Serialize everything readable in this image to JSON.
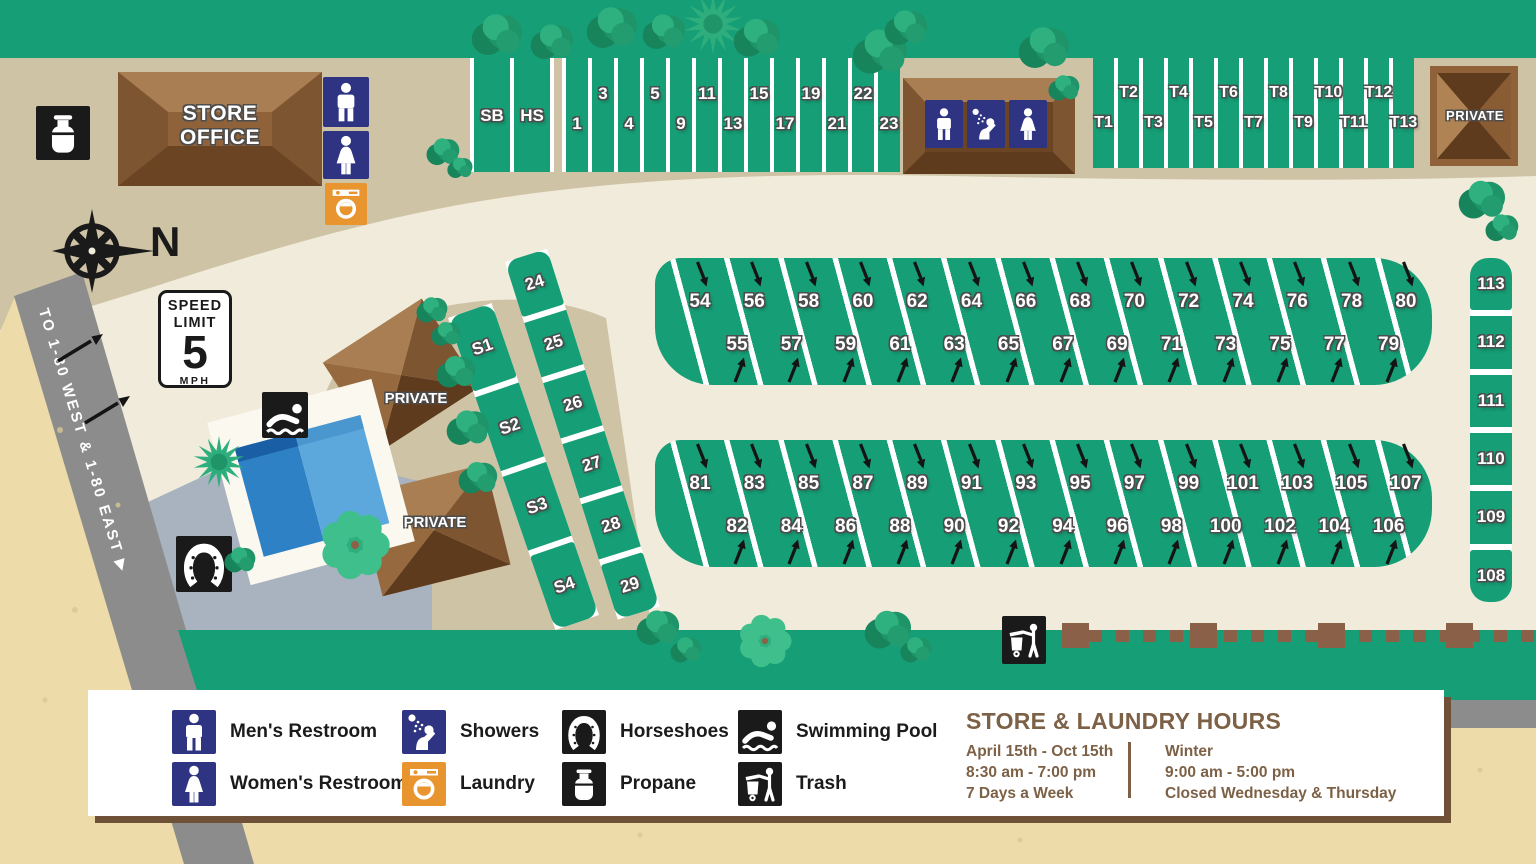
{
  "map": {
    "store": {
      "line1": "STORE",
      "line2": "OFFICE"
    },
    "private_top": "PRIVATE",
    "private_house1": "PRIVATE",
    "private_house2": "PRIVATE",
    "compass_label": "N",
    "speed_sign": {
      "l1": "SPEED",
      "l2": "LIMIT",
      "value": "5",
      "unit": "MPH"
    },
    "road_label": "TO 1-80 WEST & 1-80 EAST ▶",
    "sites": {
      "special": [
        "SB",
        "HS"
      ],
      "front_row": [
        "1",
        "3",
        "4",
        "5",
        "9",
        "11",
        "13",
        "15",
        "17",
        "19",
        "21",
        "22",
        "23"
      ],
      "tent_row": [
        "T1",
        "T2",
        "T3",
        "T4",
        "T5",
        "T6",
        "T7",
        "T8",
        "T9",
        "T10",
        "T11",
        "T12",
        "T13"
      ],
      "band1_top": [
        "54",
        "56",
        "58",
        "60",
        "62",
        "64",
        "66",
        "68",
        "70",
        "72",
        "74",
        "76",
        "78",
        "80"
      ],
      "band1_bottom": [
        "55",
        "57",
        "59",
        "61",
        "63",
        "65",
        "67",
        "69",
        "71",
        "73",
        "75",
        "77",
        "79"
      ],
      "band2_top": [
        "81",
        "83",
        "85",
        "87",
        "89",
        "91",
        "93",
        "95",
        "97",
        "99",
        "101",
        "103",
        "105",
        "107"
      ],
      "band2_bottom": [
        "82",
        "84",
        "86",
        "88",
        "90",
        "92",
        "94",
        "96",
        "98",
        "100",
        "102",
        "104",
        "106"
      ],
      "east_column": [
        "113",
        "112",
        "111",
        "110",
        "109",
        "108"
      ],
      "s_row": [
        "S1",
        "S2",
        "S3",
        "S4"
      ],
      "row_24": [
        "24",
        "25",
        "26",
        "27",
        "28",
        "29"
      ]
    }
  },
  "legend": {
    "items": [
      {
        "icon": "mens-restroom",
        "label": "Men's Restroom",
        "color": "#2E3482"
      },
      {
        "icon": "womens-restroom",
        "label": "Women's Restroom",
        "color": "#2E3482"
      },
      {
        "icon": "showers",
        "label": "Showers",
        "color": "#2E3482"
      },
      {
        "icon": "laundry",
        "label": "Laundry",
        "color": "#E8952F"
      },
      {
        "icon": "horseshoes",
        "label": "Horseshoes",
        "color": "#1A1A1A"
      },
      {
        "icon": "propane",
        "label": "Propane",
        "color": "#1A1A1A"
      },
      {
        "icon": "swimming-pool",
        "label": "Swimming Pool",
        "color": "#1A1A1A"
      },
      {
        "icon": "trash",
        "label": "Trash",
        "color": "#1A1A1A"
      }
    ],
    "hours": {
      "title": "STORE & LAUNDRY HOURS",
      "season1": [
        "April 15th - Oct 15th",
        "8:30 am - 7:00 pm",
        "7 Days a Week"
      ],
      "season2": [
        "Winter",
        "9:00 am - 5:00 pm",
        "Closed Wednesday & Thursday"
      ]
    }
  },
  "colors": {
    "green": "#169E76",
    "tan": "#CFC3A6",
    "cream": "#F1EBDB",
    "sandy": "#EDDCA9",
    "road": "#8C8C8C",
    "patio": "#A9B2BF",
    "brown": "#8F6239",
    "blue": "#2E3482",
    "orange": "#E8952F",
    "black": "#1A1A1A",
    "hours_text": "#7D6146"
  }
}
